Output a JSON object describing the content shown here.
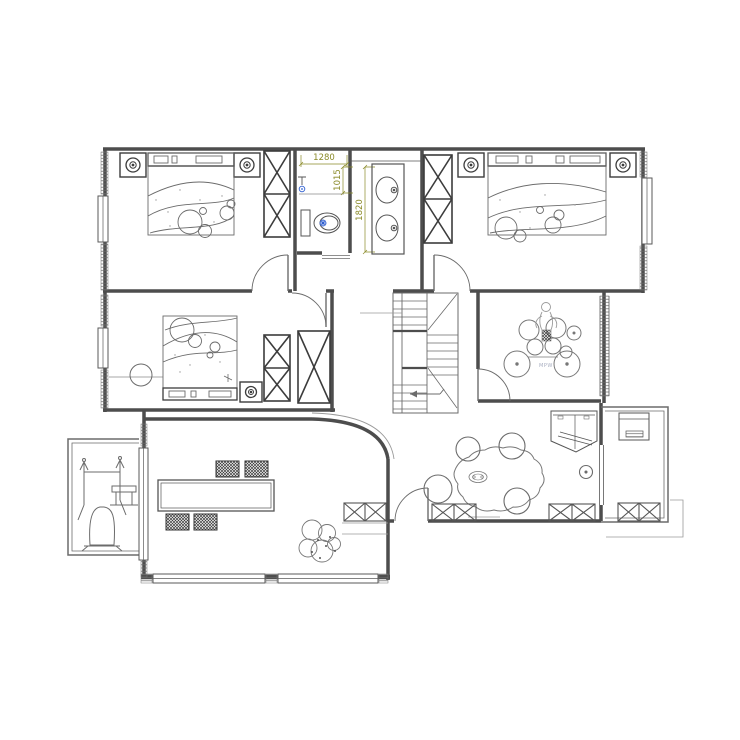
{
  "plan": {
    "type": "residential-floor-plan",
    "dimensions": {
      "width_1280": "1280",
      "depth_1015": "1015",
      "height_1820": "1820"
    },
    "labels": {
      "drum_kit_label": "MPW"
    },
    "colors": {
      "wall": "#4d4d4d",
      "furniture_bold": "#3c3c3c",
      "furniture_light": "#6b6b6b",
      "dimension_text": "#8a8a28",
      "fixture_accent": "#2f5fd0",
      "background": "#ffffff"
    },
    "icons": {
      "bed-icon": "rect+curves",
      "nightstand-lamp-icon": "double-circle",
      "wardrobe-icon": "x-box",
      "toilet-icon": "oval+tank",
      "shower-icon": "blue-dot-spray",
      "vanity-sinks-icon": "two-ovals",
      "stairs-icon": "treads+arrow",
      "drum-kit-icon": "circle-cluster",
      "tea-table-icon": "organic-blob",
      "dining-table-icon": "double-rect",
      "dining-chair-icon": "crosshatch-rect",
      "plant-icon": "scalloped-circles",
      "exercise-machine-icon": "frame+bell-base",
      "washing-machine-icon": "rect-front",
      "corner-tv-cabinet-icon": "pentagon+diagonal-tv",
      "base-cabinet-icon": "low-x-box",
      "door-icon": "quarter-arc",
      "window-icon": "triple-line",
      "wall-window-hatch": "dense-ticks"
    }
  }
}
